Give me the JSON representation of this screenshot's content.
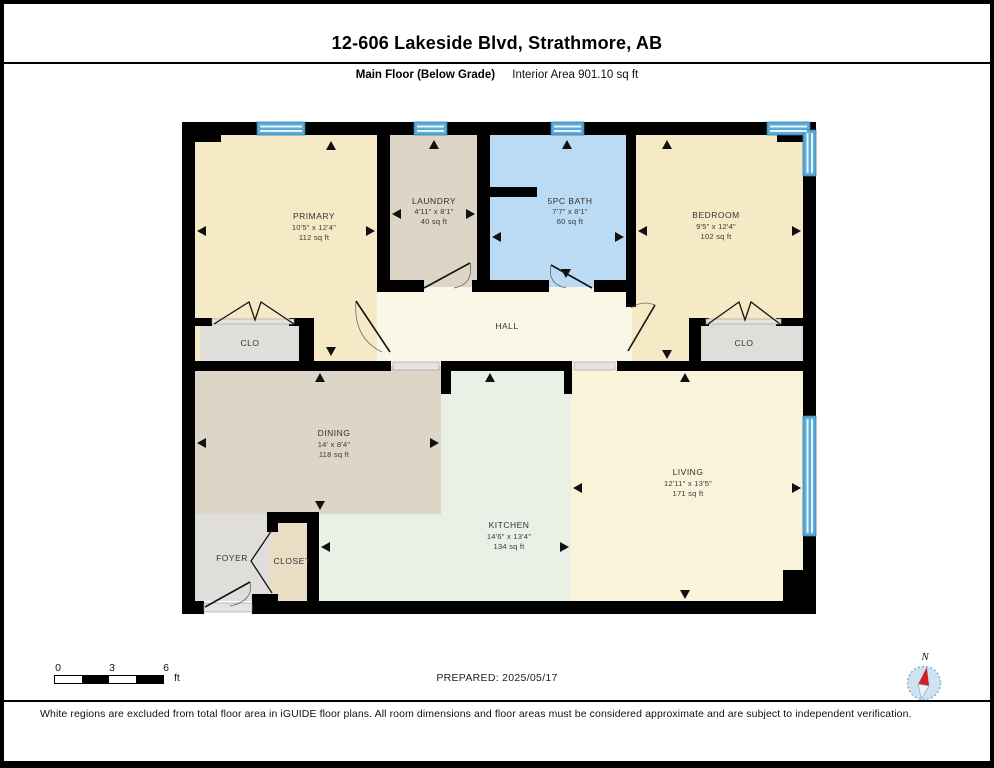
{
  "header": {
    "title": "12-606 Lakeside Blvd, Strathmore, AB",
    "floor_label": "Main Floor (Below Grade)",
    "area_label": "Interior Area 901.10 sq ft"
  },
  "rooms": {
    "primary": {
      "name": "PRIMARY",
      "dims": "10'5\" x 12'4\"",
      "area": "112 sq ft"
    },
    "laundry": {
      "name": "LAUNDRY",
      "dims": "4'11\" x 8'1\"",
      "area": "40 sq ft"
    },
    "bath": {
      "name": "5PC BATH",
      "dims": "7'7\" x 8'1\"",
      "area": "60 sq ft"
    },
    "bedroom": {
      "name": "BEDROOM",
      "dims": "9'5\" x 12'4\"",
      "area": "102 sq ft"
    },
    "hall": {
      "name": "HALL"
    },
    "clo_primary": {
      "name": "CLO"
    },
    "clo_bedroom": {
      "name": "CLO"
    },
    "dining": {
      "name": "DINING",
      "dims": "14' x 8'4\"",
      "area": "118 sq ft"
    },
    "kitchen": {
      "name": "KITCHEN",
      "dims": "14'6\" x 13'4\"",
      "area": "134 sq ft"
    },
    "living": {
      "name": "LIVING",
      "dims": "12'11\" x 13'5\"",
      "area": "171 sq ft"
    },
    "foyer": {
      "name": "FOYER"
    },
    "closet": {
      "name": "CLOSET"
    }
  },
  "footer": {
    "prepared": "PREPARED: 2025/05/17",
    "disclaimer": "White regions are excluded from total floor area in iGUIDE floor plans. All room dimensions and floor areas must be considered approximate and are subject to independent verification."
  },
  "scale_bar": {
    "tick0": "0",
    "tick1": "3",
    "tick2": "6",
    "unit": "ft"
  },
  "compass": {
    "north_label": "N"
  },
  "colors": {
    "wall": "#000000",
    "cream": "#f6e9c6",
    "tan": "#ddd5c6",
    "bath_blue": "#badbf3",
    "hall_ivory": "#fbf7e6",
    "living_cream": "#f9f3da",
    "kitchen_green": "#e9f0e5",
    "closet_gray": "#dfdeda",
    "closet_tan": "#ebdcc4",
    "window_blue": "#5aabd8"
  }
}
